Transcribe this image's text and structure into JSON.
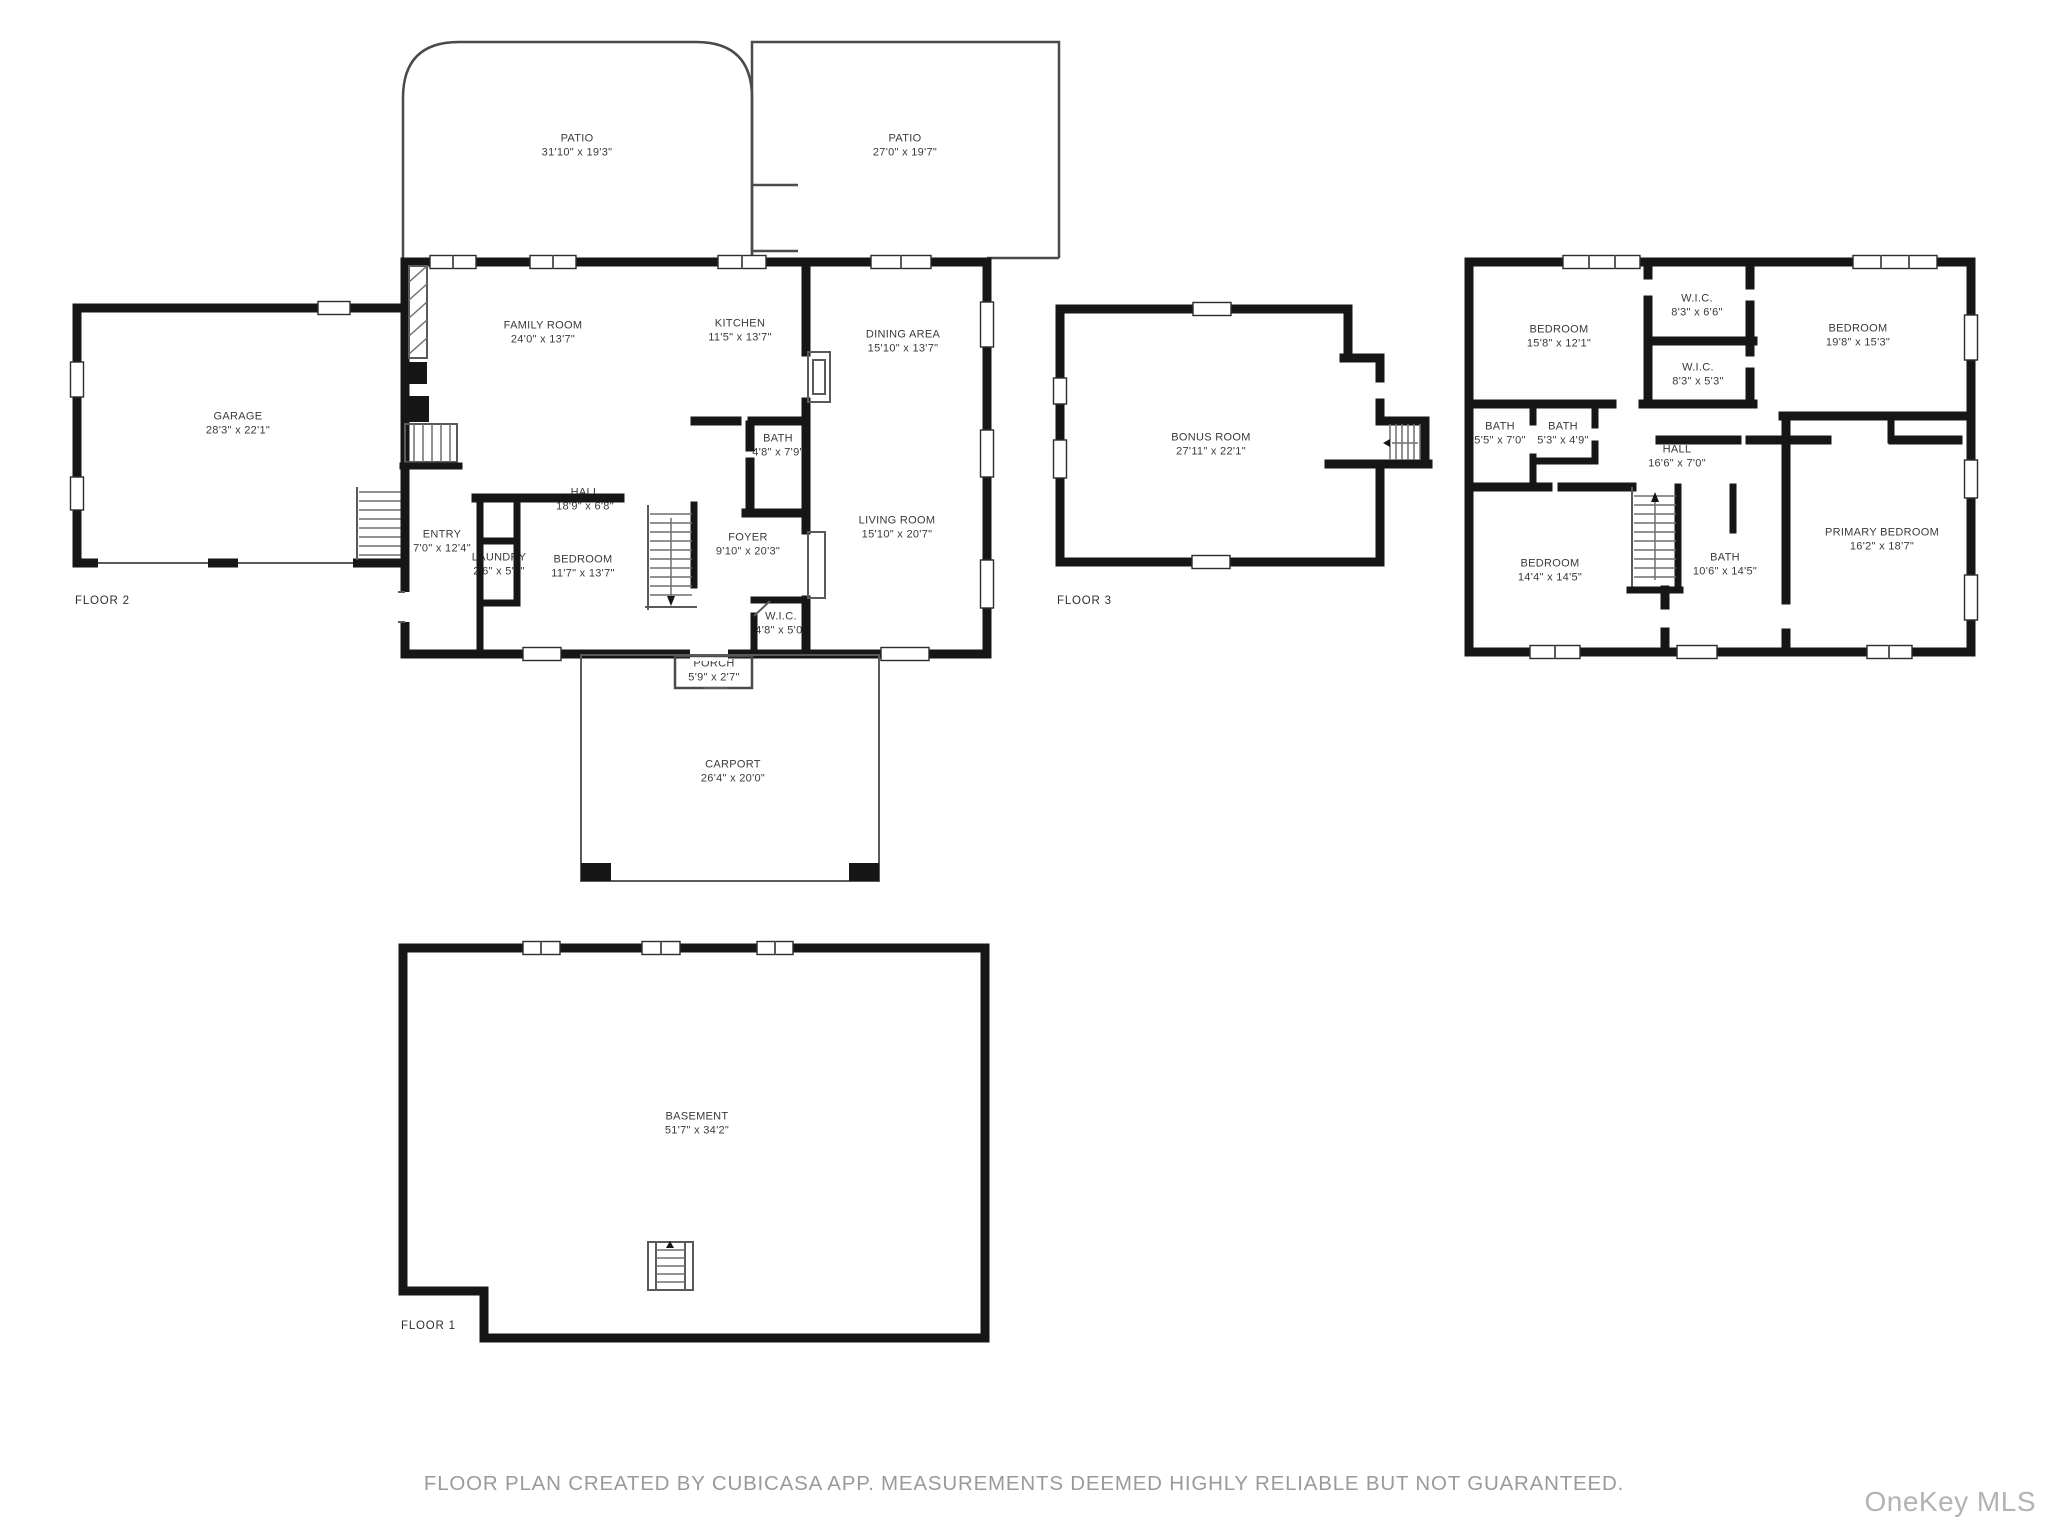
{
  "footer": {
    "disclaimer": "FLOOR PLAN CREATED BY CUBICASA APP. MEASUREMENTS DEEMED HIGHLY RELIABLE BUT NOT GUARANTEED."
  },
  "watermark": {
    "text": "OneKey MLS"
  },
  "colors": {
    "background": "#ffffff",
    "wall": "#161616",
    "thin_line": "#4a4a4a",
    "label_text": "#3a3a3a",
    "footer_text": "#9a9a9a",
    "watermark_text": "#b3b3b3"
  },
  "floors": [
    {
      "id": "floor-2",
      "label": "FLOOR 2",
      "rooms": [
        {
          "name": "PATIO",
          "dims": "31'10\" x 19'3\""
        },
        {
          "name": "PATIO",
          "dims": "27'0\" x 19'7\""
        },
        {
          "name": "GARAGE",
          "dims": "28'3\" x 22'1\""
        },
        {
          "name": "FAMILY ROOM",
          "dims": "24'0\" x 13'7\""
        },
        {
          "name": "KITCHEN",
          "dims": "11'5\" x 13'7\""
        },
        {
          "name": "DINING AREA",
          "dims": "15'10\" x 13'7\""
        },
        {
          "name": "HALL",
          "dims": "18'9\" x 6'8\""
        },
        {
          "name": "BATH",
          "dims": "4'8\" x 7'9\""
        },
        {
          "name": "ENTRY",
          "dims": "7'0\" x 12'4\""
        },
        {
          "name": "LAUNDRY",
          "dims": "2'6\" x 5'0\""
        },
        {
          "name": "BEDROOM",
          "dims": "11'7\" x 13'7\""
        },
        {
          "name": "FOYER",
          "dims": "9'10\" x 20'3\""
        },
        {
          "name": "LIVING ROOM",
          "dims": "15'10\" x 20'7\""
        },
        {
          "name": "W.I.C.",
          "dims": "4'8\" x 5'0\""
        },
        {
          "name": "PORCH",
          "dims": "5'9\" x 2'7\""
        },
        {
          "name": "CARPORT",
          "dims": "26'4\" x 20'0\""
        }
      ]
    },
    {
      "id": "floor-3",
      "label": "FLOOR 3",
      "rooms": [
        {
          "name": "BONUS ROOM",
          "dims": "27'11\" x 22'1\""
        },
        {
          "name": "BEDROOM",
          "dims": "15'8\" x 12'1\""
        },
        {
          "name": "W.I.C.",
          "dims": "8'3\" x 6'6\""
        },
        {
          "name": "W.I.C.",
          "dims": "8'3\" x 5'3\""
        },
        {
          "name": "BEDROOM",
          "dims": "19'8\" x 15'3\""
        },
        {
          "name": "BATH",
          "dims": "5'5\" x 7'0\""
        },
        {
          "name": "BATH",
          "dims": "5'3\" x 4'9\""
        },
        {
          "name": "HALL",
          "dims": "16'6\" x 7'0\""
        },
        {
          "name": "BEDROOM",
          "dims": "14'4\" x 14'5\""
        },
        {
          "name": "BATH",
          "dims": "10'6\" x 14'5\""
        },
        {
          "name": "PRIMARY BEDROOM",
          "dims": "16'2\" x 18'7\""
        }
      ]
    },
    {
      "id": "floor-1",
      "label": "FLOOR 1",
      "rooms": [
        {
          "name": "BASEMENT",
          "dims": "51'7\" x 34'2\""
        }
      ]
    }
  ]
}
